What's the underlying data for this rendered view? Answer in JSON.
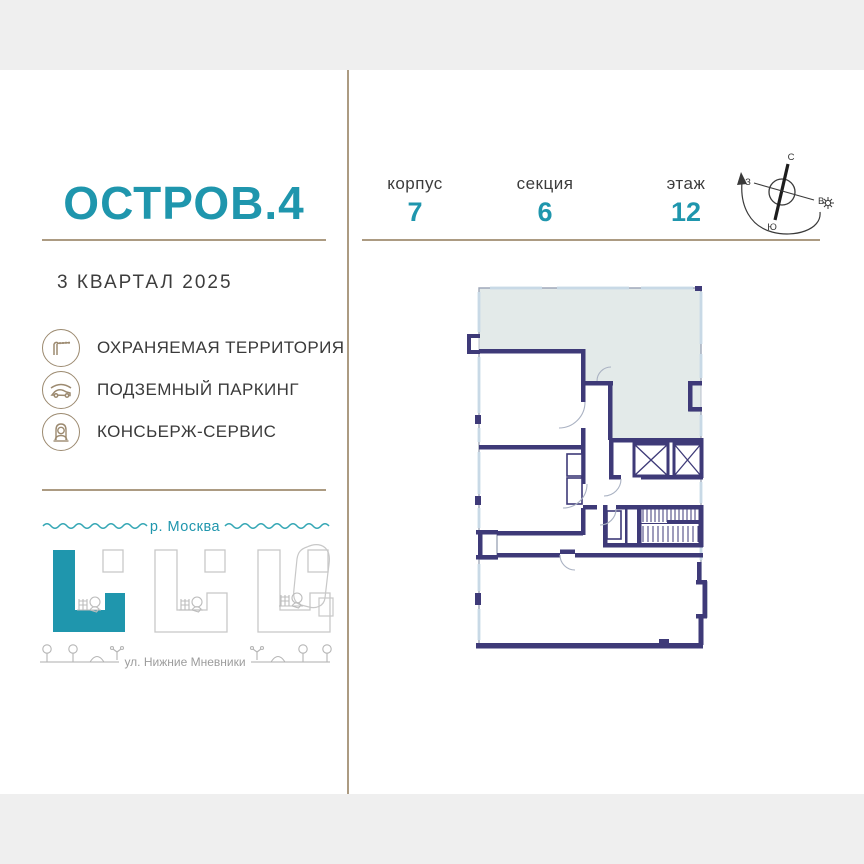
{
  "brand": {
    "title": "ОСТРОВ.4",
    "completion": "3 КВАРТАЛ 2025"
  },
  "stats": [
    {
      "label": "корпус",
      "value": "7"
    },
    {
      "label": "секция",
      "value": "6"
    },
    {
      "label": "этаж",
      "value": "12"
    }
  ],
  "amenities": [
    {
      "icon": "barrier-icon",
      "label": "ОХРАНЯЕМАЯ ТЕРРИТОРИЯ"
    },
    {
      "icon": "car-icon",
      "label": "ПОДЗЕМНЫЙ ПАРКИНГ"
    },
    {
      "icon": "concierge-icon",
      "label": "КОНСЬЕРЖ-СЕРВИС"
    }
  ],
  "site_map": {
    "river_label": "р. Москва",
    "street_label": "ул. Нижние Мневники"
  },
  "compass": {
    "north": "С",
    "south": "Ю",
    "west": "З",
    "east": "В"
  },
  "colors": {
    "accent": "#1f96ad",
    "wall_navy": "#3e3a78",
    "unit_highlight": "#e3eae9",
    "divider_tan": "#ac9b82",
    "icon_tan": "#9c8a70",
    "frame_gray": "#efefef"
  }
}
